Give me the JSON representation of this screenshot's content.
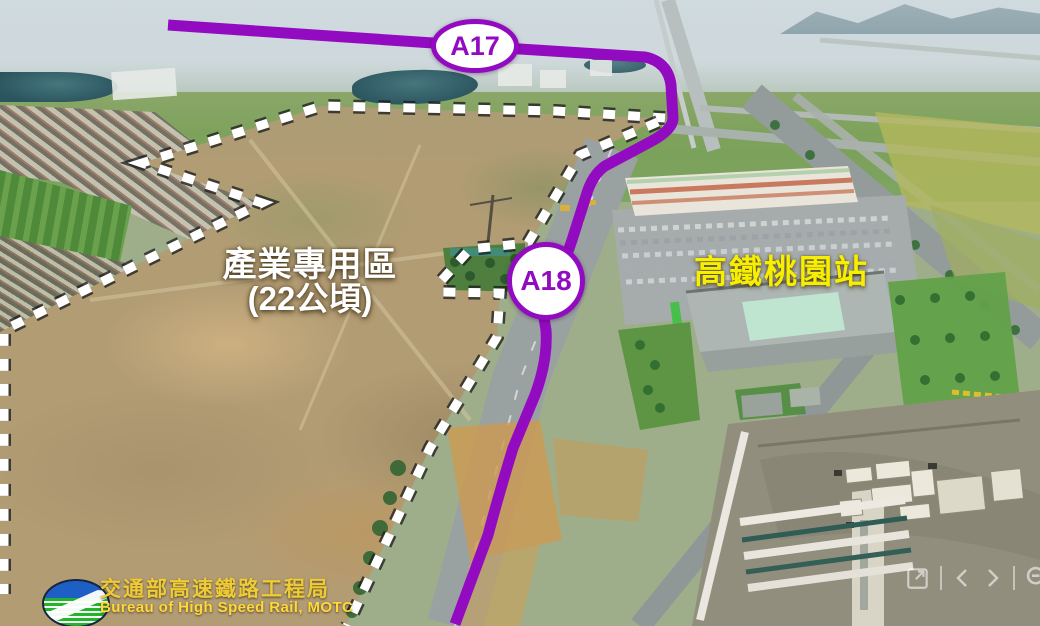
{
  "map_labels": {
    "route_badge_a17": "A17",
    "route_badge_a18": "A18",
    "zone_title": "產業專用區",
    "zone_area": "(22公頃)",
    "station_name": "高鐵桃園站"
  },
  "footer_logo": {
    "org_name_zh": "交通部高速鐵路工程局",
    "org_name_en": "Bureau of High Speed Rail, MOTC"
  },
  "viewer_controls": {
    "icons": [
      "expand-icon",
      "chevron-left-icon",
      "chevron-right-icon",
      "zoom-out-icon"
    ]
  },
  "colors": {
    "route_purple": "#930bc0",
    "boundary_dash": "#ffffff",
    "zone_label_text": "#ffffff",
    "station_label_text": "#f6ef00",
    "logo_text_yellow": "#eecb37"
  }
}
